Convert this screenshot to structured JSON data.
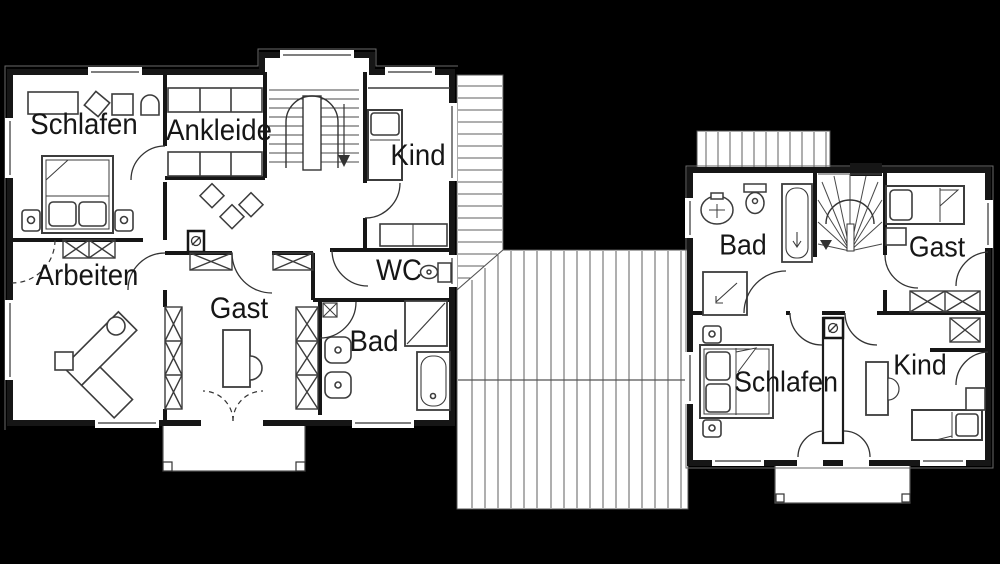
{
  "drawing": {
    "type": "floor-plan",
    "background_color": "#000000",
    "floor_color": "#ffffff",
    "wall_color": "#161616",
    "furniture_line_color": "#3c3c3c",
    "roof_hatch_color": "#5f5f5f"
  },
  "left_plan": {
    "rooms": [
      {
        "id": "schlafen",
        "label": "Schlafen"
      },
      {
        "id": "ankleide",
        "label": "Ankleide"
      },
      {
        "id": "kind",
        "label": "Kind"
      },
      {
        "id": "arbeiten",
        "label": "Arbeiten"
      },
      {
        "id": "gast",
        "label": "Gast"
      },
      {
        "id": "wc",
        "label": "WC"
      },
      {
        "id": "bad",
        "label": "Bad"
      }
    ]
  },
  "right_plan": {
    "rooms": [
      {
        "id": "bad",
        "label": "Bad"
      },
      {
        "id": "gast",
        "label": "Gast"
      },
      {
        "id": "schlafen",
        "label": "Schlafen"
      },
      {
        "id": "kind",
        "label": "Kind"
      }
    ]
  }
}
